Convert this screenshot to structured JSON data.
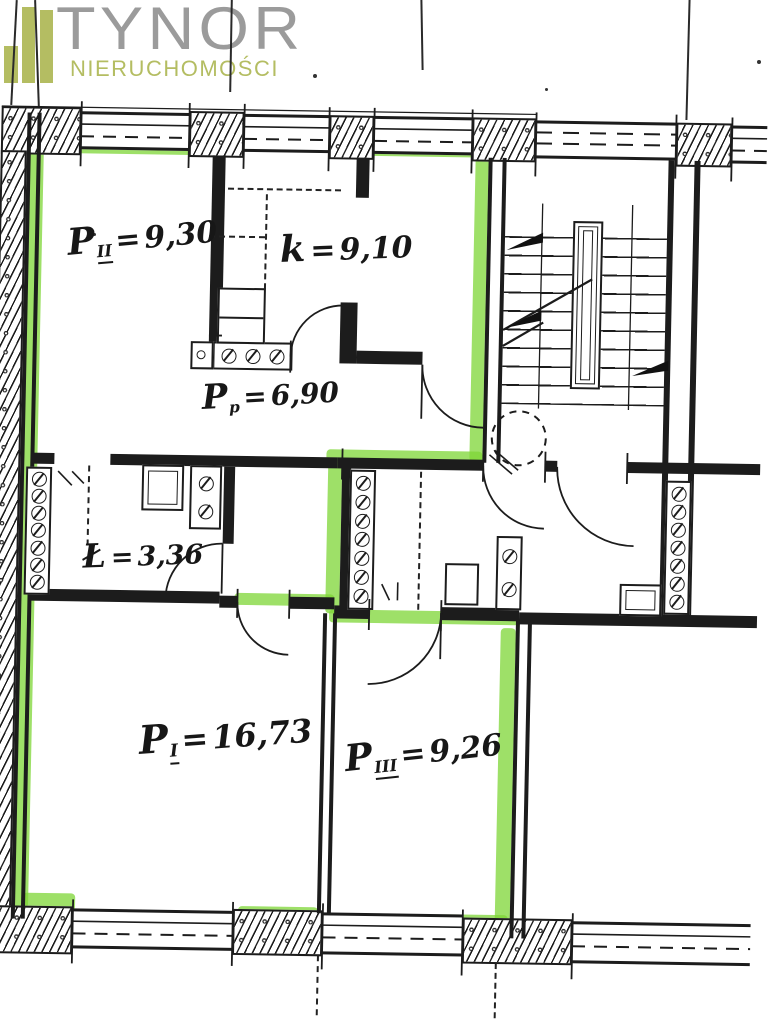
{
  "logo": {
    "title": "TYNOR",
    "subtitle": "NIERUCHOMOŚCI"
  },
  "rooms": [
    {
      "id": "P_II",
      "symbol": "P",
      "subscript": "II",
      "equals": "=",
      "area": "9,30"
    },
    {
      "id": "k",
      "symbol": "k",
      "subscript": "",
      "equals": "=",
      "area": "9,10"
    },
    {
      "id": "P_p",
      "symbol": "P",
      "subscript": "p",
      "equals": "=",
      "area": "6,90"
    },
    {
      "id": "L",
      "symbol": "Ł",
      "subscript": "",
      "equals": "=",
      "area": "3,36"
    },
    {
      "id": "P_I",
      "symbol": "P",
      "subscript": "I",
      "equals": "=",
      "area": "16,73"
    },
    {
      "id": "P_III",
      "symbol": "P",
      "subscript": "III",
      "equals": "=",
      "area": "9,26"
    }
  ],
  "colors": {
    "highlight": "#7ed636",
    "wall": "#1c1c1c",
    "logo_gray": "#9b9b9b",
    "logo_olive": "#b4bd62",
    "paper": "#ffffff"
  }
}
